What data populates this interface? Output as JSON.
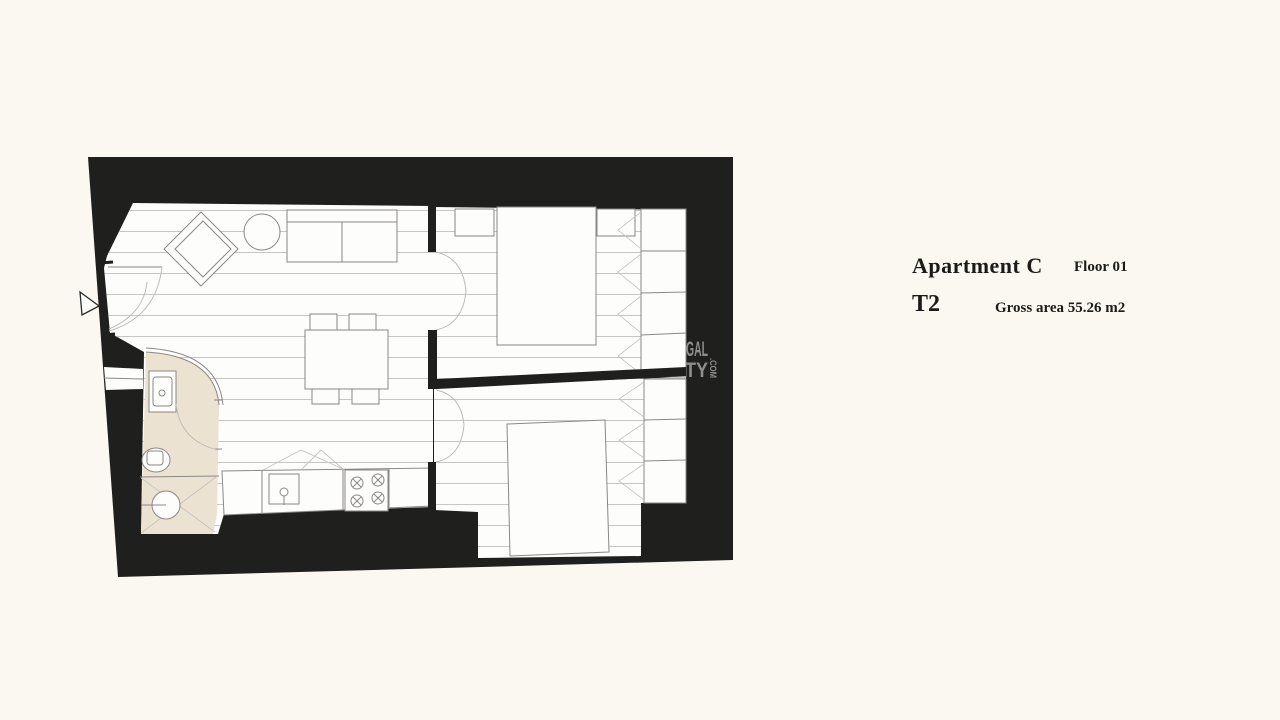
{
  "info": {
    "apartment_name": "Apartment C",
    "floor_label": "Floor 01",
    "typology": "T2",
    "gross_area": "Gross area 55.26 m2"
  },
  "watermark": {
    "fragment_top": "GAL",
    "fragment_bottom": "TY",
    "fragment_suffix": ".COM"
  },
  "colors": {
    "background": "#fbf8f1",
    "wall_black": "#1f1f1d",
    "floor_line": "#c8c6c2",
    "bathroom_floor": "#ece2d1",
    "furniture_stroke": "#8a8886",
    "watermark_gray": "#8e8e8e"
  },
  "plan": {
    "marker_icons": [
      "entrance-arrow"
    ],
    "furniture_icons": [
      "sofa",
      "armchair",
      "round-side-table",
      "dining-table",
      "dining-chair",
      "kitchen-counter",
      "kitchen-sink",
      "kitchen-hob",
      "bathroom-sink",
      "toilet",
      "shower",
      "bed",
      "nightstand",
      "wardrobe",
      "door-swing-arc"
    ]
  }
}
